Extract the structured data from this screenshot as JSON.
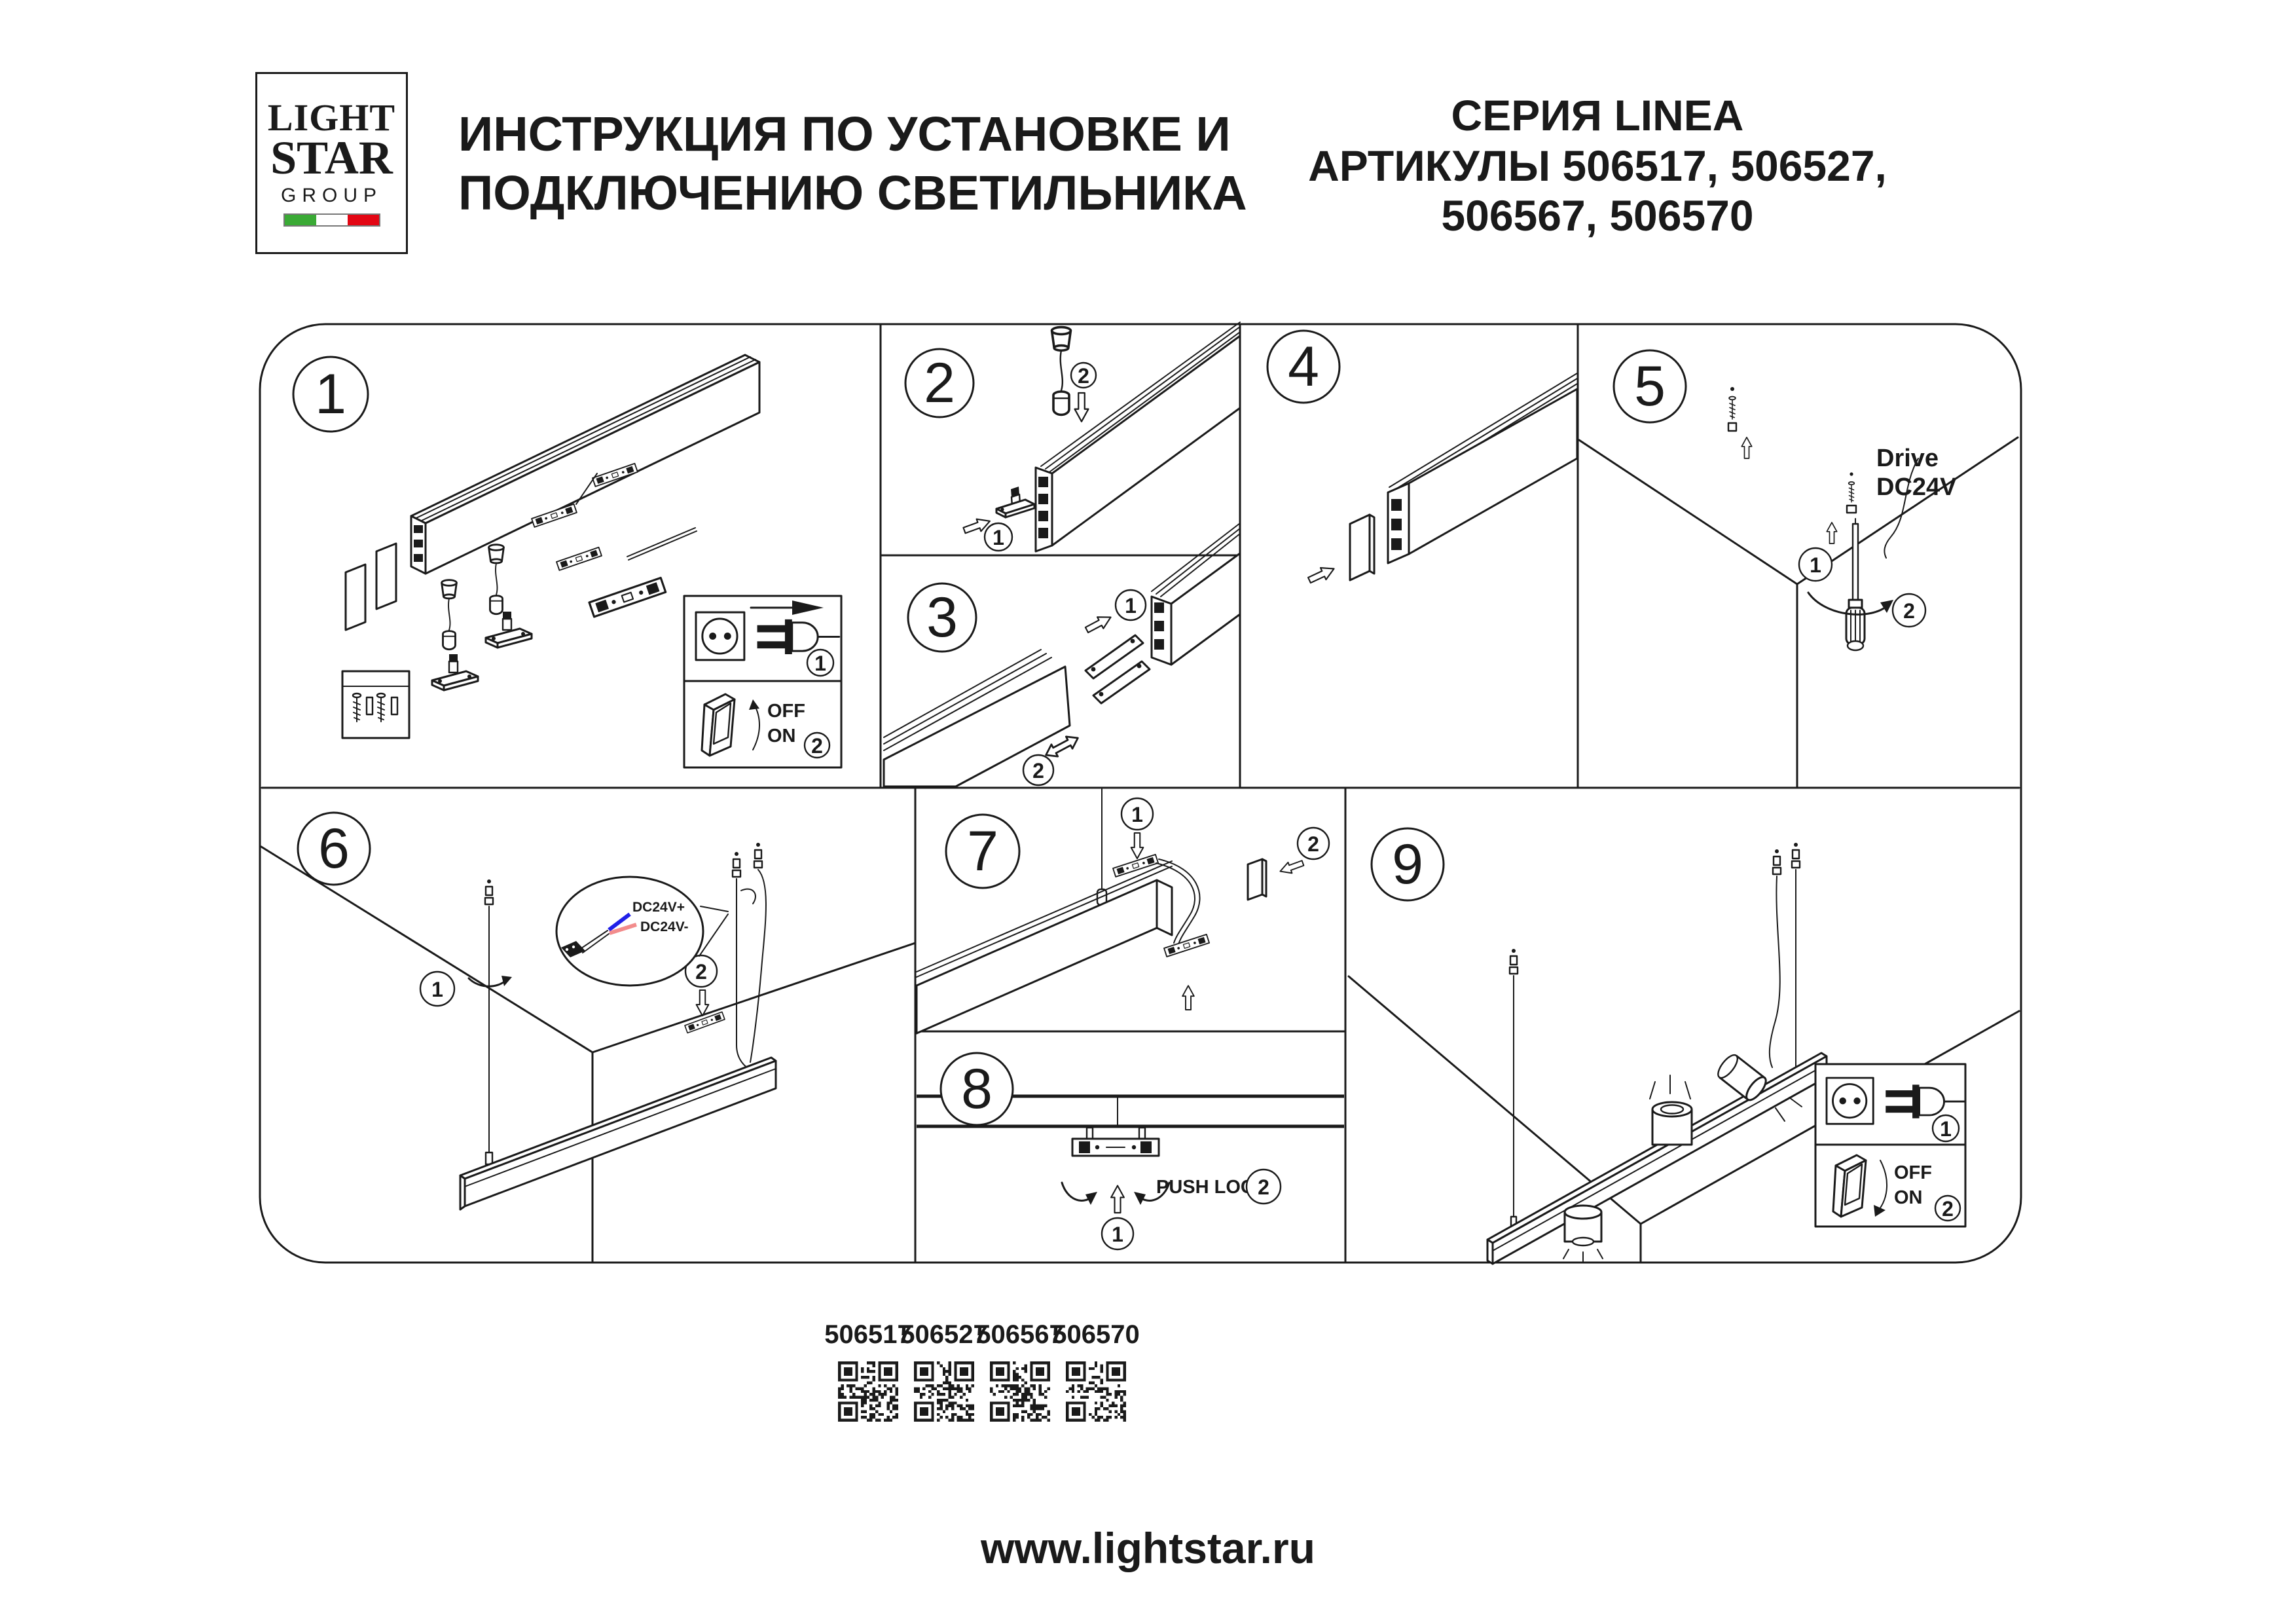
{
  "header": {
    "logo": {
      "line1": "LIGHT",
      "line2": "STAR",
      "line3": "GROUP"
    },
    "title_line1": "ИНСТРУКЦИЯ ПО УСТАНОВКЕ И",
    "title_line2": "ПОДКЛЮЧЕНИЮ СВЕТИЛЬНИКА",
    "series": "СЕРИЯ LINEA",
    "articles_line1": "АРТИКУЛЫ 506517, 506527,",
    "articles_line2": "506567, 506570"
  },
  "panels": {
    "p1": {
      "number": "1",
      "step1": "1",
      "step2": "2",
      "off": "OFF",
      "on": "ON"
    },
    "p2": {
      "number": "2",
      "step1": "1",
      "step2": "2"
    },
    "p3": {
      "number": "3",
      "step1": "1",
      "step2": "2"
    },
    "p4": {
      "number": "4"
    },
    "p5": {
      "number": "5",
      "step1": "1",
      "step2": "2",
      "label_line1": "Drive",
      "label_line2": "DC24V"
    },
    "p6": {
      "number": "6",
      "step1": "1",
      "step2": "2",
      "wire_pos": "DC24V+",
      "wire_neg": "DC24V-"
    },
    "p7": {
      "number": "7",
      "step1": "1",
      "step2": "2"
    },
    "p8": {
      "number": "8",
      "step1": "1",
      "step2": "2",
      "push_lock": "PUSH LOCK"
    },
    "p9": {
      "number": "9",
      "step1": "1",
      "step2": "2",
      "off": "OFF",
      "on": "ON"
    }
  },
  "footer": {
    "qr_items": [
      {
        "label": "506517"
      },
      {
        "label": "506527"
      },
      {
        "label": "506567"
      },
      {
        "label": "506570"
      }
    ],
    "url": "www.lightstar.ru"
  },
  "colors": {
    "ink": "#1a1a1a",
    "wire_positive": "#2020e8",
    "wire_negative": "#f28c8c",
    "flag_green": "#3aaa35",
    "flag_white": "#ffffff",
    "flag_red": "#e30613"
  }
}
